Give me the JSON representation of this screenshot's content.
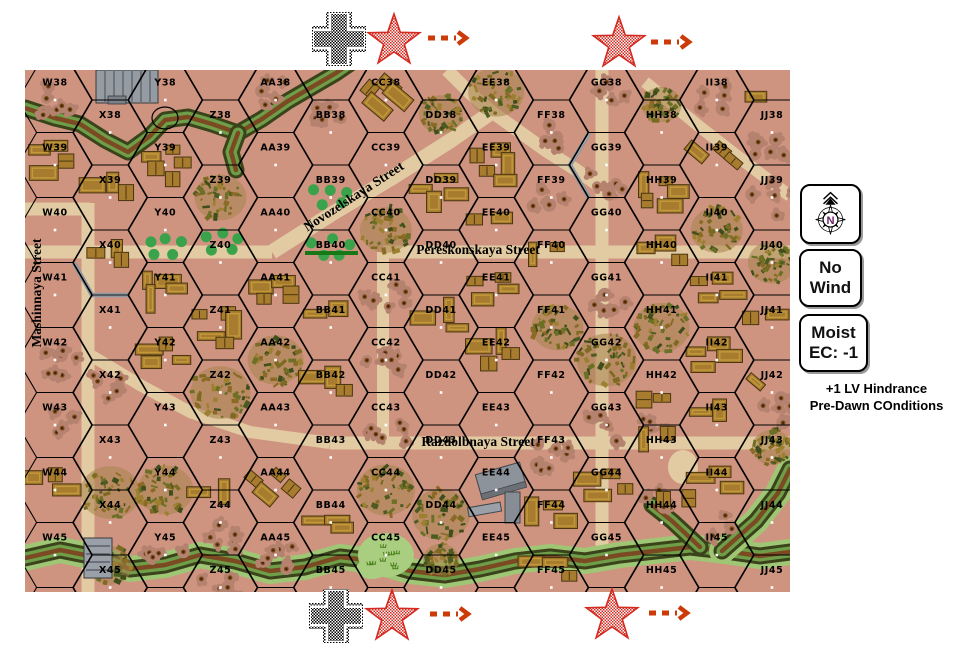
{
  "side_panel": {
    "compass_label": "N",
    "wind_box": [
      "No",
      "Wind"
    ],
    "ec_box": [
      "Moist",
      "EC: -1"
    ],
    "notes": [
      "+1 LV Hindrance",
      "Pre-Dawn COnditions"
    ]
  },
  "markers": {
    "top": [
      {
        "type": "german-cross",
        "x": 339,
        "y": 39
      },
      {
        "type": "red-star",
        "x": 394,
        "y": 41
      },
      {
        "type": "arrow",
        "x": 428,
        "y": 38
      },
      {
        "type": "red-star",
        "x": 619,
        "y": 44
      },
      {
        "type": "arrow",
        "x": 651,
        "y": 42
      }
    ],
    "bottom": [
      {
        "type": "german-cross",
        "x": 336,
        "y": 616
      },
      {
        "type": "red-star",
        "x": 392,
        "y": 617
      },
      {
        "type": "arrow",
        "x": 430,
        "y": 614
      },
      {
        "type": "red-star",
        "x": 612,
        "y": 616
      },
      {
        "type": "arrow",
        "x": 649,
        "y": 613
      }
    ]
  },
  "map": {
    "columns": [
      "W",
      "X",
      "Y",
      "Z",
      "AA",
      "BB",
      "CC",
      "DD",
      "EE",
      "FF",
      "GG",
      "HH",
      "II",
      "JJ"
    ],
    "row_start": 38,
    "row_end": 45,
    "colors": {
      "ground": "#ce9480",
      "street": "#e2cba2",
      "hexline": "#000000",
      "building_fill": "#a87c2e",
      "building_edge": "#4a3510",
      "building_roof": "#c29a3c",
      "stone": "#959ba3",
      "orchard": "#3ba24c",
      "marsh": "#aace80",
      "river_dark": "#3b431b",
      "river_green": "#6f9e49",
      "river_brown": "#7c4a22",
      "river_light": "#9fc674",
      "wall": "#8e98a2",
      "hedge": "#187818",
      "star_red": "#d42a20",
      "arrow": "#cc3a08",
      "compass_n": "#6b2566"
    },
    "street_labels": [
      {
        "text": "Novozelskaya Street",
        "x": 356,
        "y": 200,
        "rotate": -33
      },
      {
        "text": "Pereskonskaya Street",
        "x": 478,
        "y": 254,
        "rotate": 0
      },
      {
        "text": "Razdolbnaya Street",
        "x": 478,
        "y": 446,
        "rotate": 0
      },
      {
        "text": "Mashinnaya Street",
        "x": 41,
        "y": 293,
        "rotate": -90
      }
    ],
    "street_paths": [
      {
        "path": "M25,209 L90,209",
        "w": 13
      },
      {
        "path": "M88,203 L88,592",
        "w": 13
      },
      {
        "path": "M25,252 L272,252",
        "w": 13
      },
      {
        "path": "M272,252 L330,215 L390,179 L450,141 L492,112",
        "w": 15
      },
      {
        "path": "M447,70 L470,93 L492,112 L545,150 L578,171 L602,188",
        "w": 13
      },
      {
        "path": "M602,70 L602,556",
        "w": 13
      },
      {
        "path": "M645,82 L700,127 L745,162 L790,196",
        "w": 12
      },
      {
        "path": "M383,252 L790,252",
        "w": 13
      },
      {
        "path": "M383,252 L383,446",
        "w": 12
      },
      {
        "path": "M92,356 L140,385 L190,412 L250,432 L330,443",
        "w": 12
      },
      {
        "path": "M330,443 L790,443",
        "w": 13
      }
    ],
    "pond": {
      "x": 683,
      "y": 467,
      "rx": 15,
      "ry": 17
    },
    "rivers": [
      {
        "path": "M25,108 L55,118 L80,124 L105,140 L128,152 L150,136 L165,120 L188,117 L212,124 L238,133 L262,119 L288,101 L312,87 L336,73 L352,62",
        "style": "plain"
      },
      {
        "path": "M238,133 L231,152 L236,170",
        "style": "plain"
      },
      {
        "path": "M25,558 L60,550 L95,557 L130,569 L165,565 L200,555 L235,561 L270,571 L305,567 L340,557 L375,561 L410,571 L445,575 L480,569 L515,561 L550,557 L585,561 L620,555 L655,551 L690,547 L725,551 L760,556 L790,552",
        "style": "light"
      },
      {
        "path": "M700,547 L672,521 L652,505",
        "style": "plain"
      },
      {
        "path": "M722,551 L756,521 L778,493 L790,469",
        "style": "light"
      }
    ],
    "walls": [
      "M74,263 L92,295 L128,295",
      "M589,133 L570,165 L589,198"
    ],
    "hedges": [
      "M305,253 L358,253"
    ],
    "bridge": {
      "x": 84,
      "y": 538,
      "w": 28,
      "h": 40
    },
    "circle_marker": {
      "x": 165,
      "y": 118,
      "rx": 13,
      "ry": 11
    },
    "terrain": {
      "woods": [
        {
          "hex": "Z39"
        },
        {
          "hex": "CC40"
        },
        {
          "hex": "DD38",
          "dy": -18,
          "r": 22
        },
        {
          "hex": "EE38",
          "dy": -8,
          "r": 28
        },
        {
          "hex": "HH38",
          "dy": -28,
          "r": 20
        },
        {
          "hex": "II40"
        },
        {
          "hex": "FF41",
          "dx": 6
        },
        {
          "hex": "GG42",
          "r": 30
        },
        {
          "hex": "HH41",
          "r": 28
        },
        {
          "hex": "Z42",
          "r": 30
        },
        {
          "hex": "AA42",
          "r": 28
        },
        {
          "hex": "X44",
          "dy": -30,
          "r": 30
        },
        {
          "hex": "Y44",
          "r": 28
        },
        {
          "hex": "X45",
          "dy": -22,
          "r": 22
        },
        {
          "hex": "CC44",
          "r": 29
        },
        {
          "hex": "DD44",
          "dy": -8,
          "r": 29
        },
        {
          "hex": "DD45",
          "dy": -28,
          "r": 18
        },
        {
          "hex": "JJ40",
          "r": 24
        },
        {
          "hex": "JJ43",
          "dy": -10,
          "r": 20
        }
      ],
      "buildings": [
        {
          "hex": "W39",
          "n": 4
        },
        {
          "hex": "X39",
          "n": 3
        },
        {
          "hex": "Y39",
          "n": 5
        },
        {
          "hex": "X40",
          "n": 3
        },
        {
          "hex": "CC38",
          "n": 4,
          "rot": 1
        },
        {
          "hex": "DD39",
          "n": 4
        },
        {
          "hex": "EE39",
          "n": 5
        },
        {
          "hex": "EE40",
          "n": 2
        },
        {
          "hex": "FF40",
          "n": 2
        },
        {
          "hex": "HH39",
          "n": 5
        },
        {
          "hex": "HH40",
          "n": 3
        },
        {
          "hex": "II39",
          "n": 3,
          "rot": 1
        },
        {
          "hex": "JJ38",
          "n": 1,
          "dy": -20
        },
        {
          "hex": "Y41",
          "n": 4
        },
        {
          "hex": "Z41",
          "n": 5
        },
        {
          "hex": "AA41",
          "n": 4
        },
        {
          "hex": "BB41",
          "n": 2
        },
        {
          "hex": "DD41",
          "n": 3
        },
        {
          "hex": "EE41",
          "n": 4
        },
        {
          "hex": "II41",
          "n": 4
        },
        {
          "hex": "JJ41",
          "n": 2
        },
        {
          "hex": "Y42",
          "n": 4
        },
        {
          "hex": "BB42",
          "n": 3
        },
        {
          "hex": "EE42",
          "n": 4
        },
        {
          "hex": "II42",
          "n": 4
        },
        {
          "hex": "HH42",
          "n": 2,
          "dy": 18
        },
        {
          "hex": "HH43",
          "n": 2,
          "dy": -8
        },
        {
          "hex": "II43",
          "n": 2
        },
        {
          "hex": "JJ42",
          "n": 1,
          "rot": 1
        },
        {
          "hex": "W44",
          "n": 3
        },
        {
          "hex": "Z44",
          "n": 2,
          "dy": -15
        },
        {
          "hex": "AA44",
          "n": 4,
          "rot": 1
        },
        {
          "hex": "BB44",
          "n": 3,
          "dy": 12
        },
        {
          "hex": "GG44",
          "n": 4
        },
        {
          "hex": "FF44",
          "n": 3
        },
        {
          "hex": "FF45",
          "n": 3,
          "dy": -10
        },
        {
          "hex": "II44",
          "n": 3
        },
        {
          "hex": "HH44",
          "n": 2,
          "dx": 22,
          "dy": -8
        }
      ],
      "shellholes": [
        {
          "hex": "W38"
        },
        {
          "hex": "AA38",
          "dy": -10
        },
        {
          "hex": "BB38",
          "dy": -25
        },
        {
          "hex": "FF38"
        },
        {
          "hex": "GG38"
        },
        {
          "hex": "GG39",
          "dy": 15
        },
        {
          "hex": "II38"
        },
        {
          "hex": "JJ38",
          "dy": 15
        },
        {
          "hex": "FF39"
        },
        {
          "hex": "JJ39"
        },
        {
          "hex": "W42"
        },
        {
          "hex": "X42",
          "dy": -12
        },
        {
          "hex": "W43"
        },
        {
          "hex": "CC41"
        },
        {
          "hex": "CC42"
        },
        {
          "hex": "CC43",
          "dy": 12
        },
        {
          "hex": "GG41"
        },
        {
          "hex": "FF43"
        },
        {
          "hex": "GG43"
        },
        {
          "hex": "HH43",
          "dy": -28
        },
        {
          "hex": "JJ42",
          "dy": 20
        },
        {
          "hex": "Z44",
          "dy": 18
        },
        {
          "hex": "Y45"
        },
        {
          "hex": "Z45"
        },
        {
          "hex": "AA45"
        },
        {
          "hex": "HH44",
          "dy": -25
        },
        {
          "hex": "II45",
          "dy": -25
        }
      ],
      "orchards": [
        {
          "hex": "Y40",
          "dy": 18
        },
        {
          "hex": "Z40",
          "dy": -18
        },
        {
          "hex": "BB39"
        },
        {
          "hex": "BB40",
          "dy": -14
        }
      ],
      "marsh": [
        {
          "hex": "CC45"
        }
      ]
    },
    "stone_buildings": [
      {
        "id": "X38-stone",
        "x": 96,
        "y": 70,
        "w": 62,
        "h": 33
      },
      {
        "id": "EE44-stone",
        "x": 477,
        "y": 465,
        "w": 48,
        "h": 60
      }
    ]
  }
}
